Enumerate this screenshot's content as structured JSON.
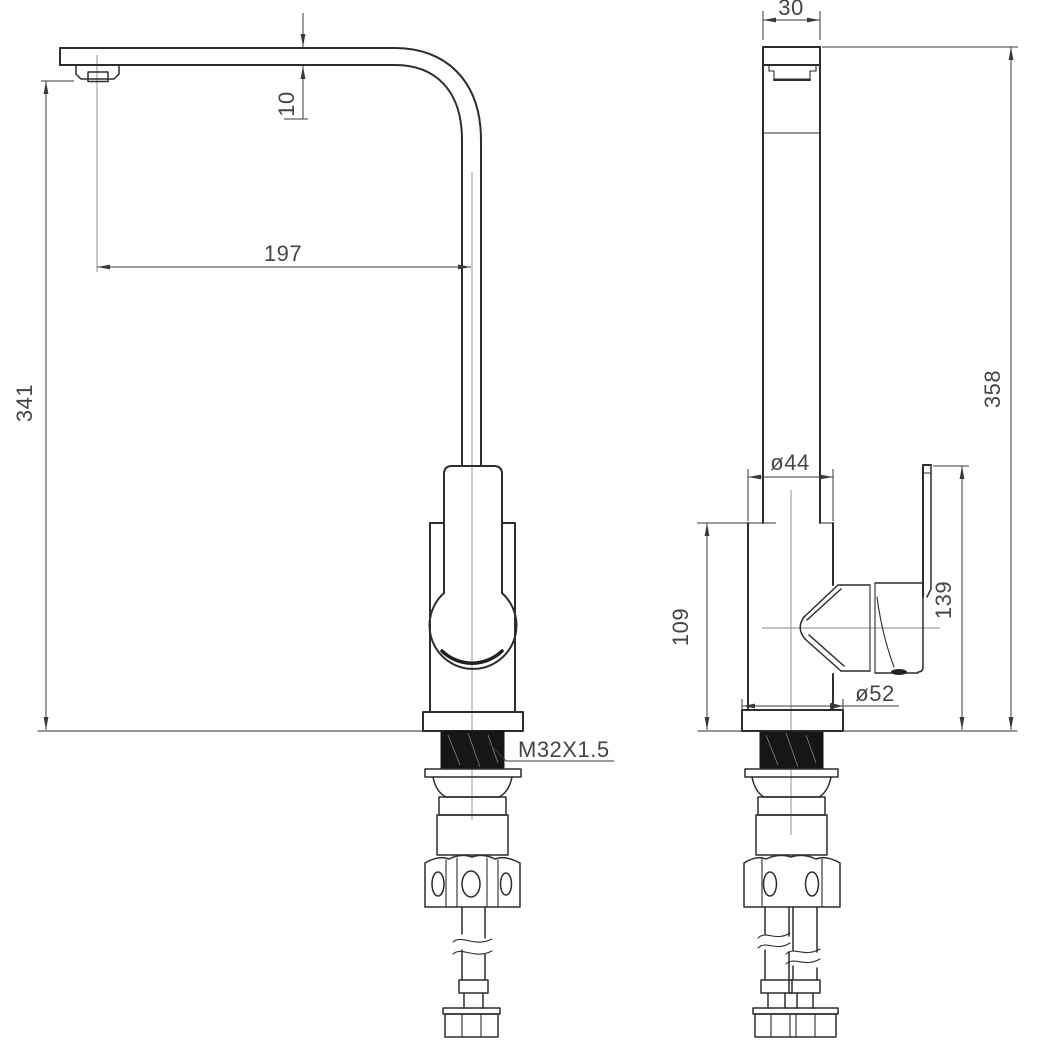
{
  "drawing": {
    "type": "technical-drawing",
    "subject": "single-lever kitchen sink mixer tap, front and side elevations",
    "units": "mm",
    "colors": {
      "background": "#ffffff",
      "line": "#2d2d2d",
      "dimension": "#3a3a3a",
      "text": "#454545"
    },
    "dims": {
      "spout_tube_width": "30",
      "spout_thickness": "10",
      "spout_reach": "197",
      "spout_height": "341",
      "overall_height": "358",
      "body_width": "ø44",
      "body_height": "109",
      "handle_top_height": "139",
      "base_diameter": "ø52",
      "mounting_thread": "M32X1.5"
    }
  }
}
